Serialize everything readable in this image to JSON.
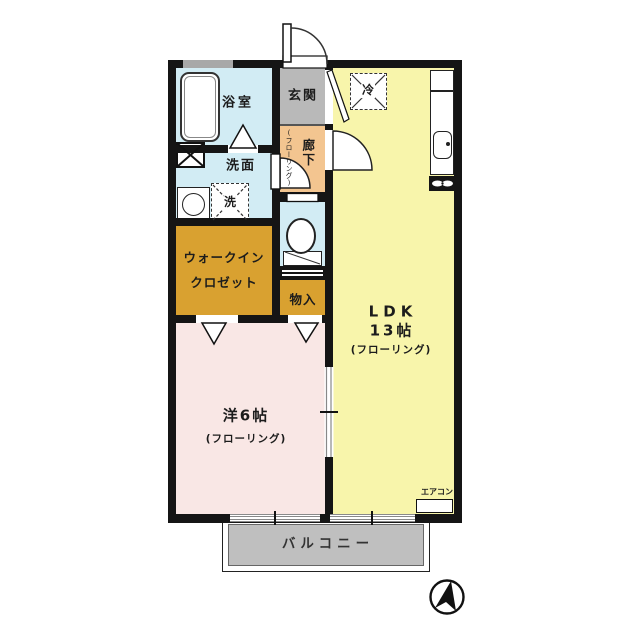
{
  "plan_title": "1LDK floor plan",
  "rooms": {
    "bathroom": {
      "name": "浴室"
    },
    "washroom": {
      "name": "洗面"
    },
    "washing_machine": {
      "name": "洗"
    },
    "entrance": {
      "name": "玄関"
    },
    "hallway": {
      "name": "廊下",
      "floor_note": "(フローリング)"
    },
    "refrigerator": {
      "name": "冷"
    },
    "walk_in_closet": {
      "name_line1": "ウォークイン",
      "name_line2": "クロゼット"
    },
    "storage": {
      "name": "物入"
    },
    "ldk": {
      "name": "LDK",
      "size": "13帖",
      "floor_note": "(フローリング)"
    },
    "western_room": {
      "name": "洋6帖",
      "floor_note": "(フローリング)"
    },
    "balcony": {
      "name": "バルコニー"
    },
    "air_conditioner": {
      "name": "エアコン"
    }
  },
  "colors": {
    "wall": "#151515",
    "wet_rooms": "#d2ecf4",
    "entrance": "#b9b9b9",
    "hallway": "#f3c590",
    "closet": "#d9a130",
    "ldk": "#f8f5ab",
    "western_room": "#f9e7e5",
    "balcony": "#bfbfbf"
  }
}
